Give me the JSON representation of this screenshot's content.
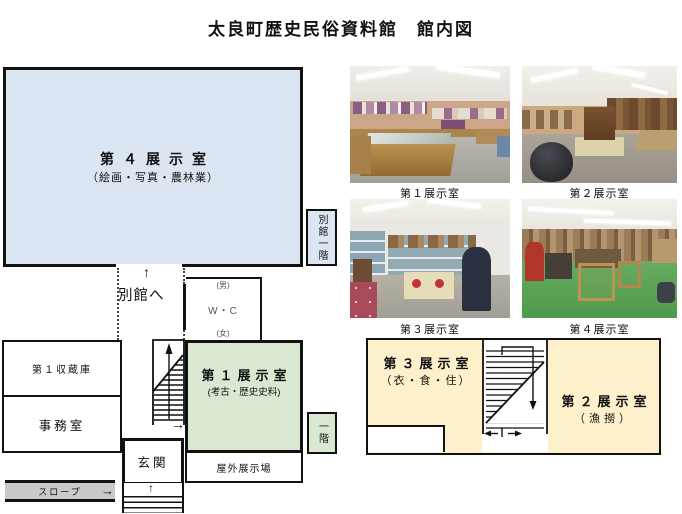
{
  "title": "太良町歴史民俗資料館　館内図",
  "floor1": {
    "room4_name": "第４展示室",
    "room4_sub": "（絵画・写真・農林業）",
    "annex_floor_label": "別館一階",
    "to_annex_label": "別館へ",
    "wc_male": "(男)",
    "wc_label": "W・C",
    "wc_female": "(女)",
    "storage_label": "第１収蔵庫",
    "office_label": "事務室",
    "entrance_label": "玄関",
    "ramp_label": "スロープ",
    "room1_name": "第１展示室",
    "room1_sub": "(考古・歴史史料)",
    "outdoor_label": "屋外展示場",
    "first_floor_tag": "一階"
  },
  "floor2": {
    "room3_name": "第３展示室",
    "room3_sub": "（衣・食・住）",
    "room2_name": "第２展示室",
    "room2_sub": "（漁撈）"
  },
  "photos": [
    {
      "caption": "第１展示室"
    },
    {
      "caption": "第２展示室"
    },
    {
      "caption": "第３展示室"
    },
    {
      "caption": "第４展示室"
    }
  ],
  "colors": {
    "room4_fill": "#dce6f2",
    "room1_fill": "#dae8d2",
    "floor2_fill": "#fdf0ca",
    "ramp_fill": "#c9c9c9"
  }
}
